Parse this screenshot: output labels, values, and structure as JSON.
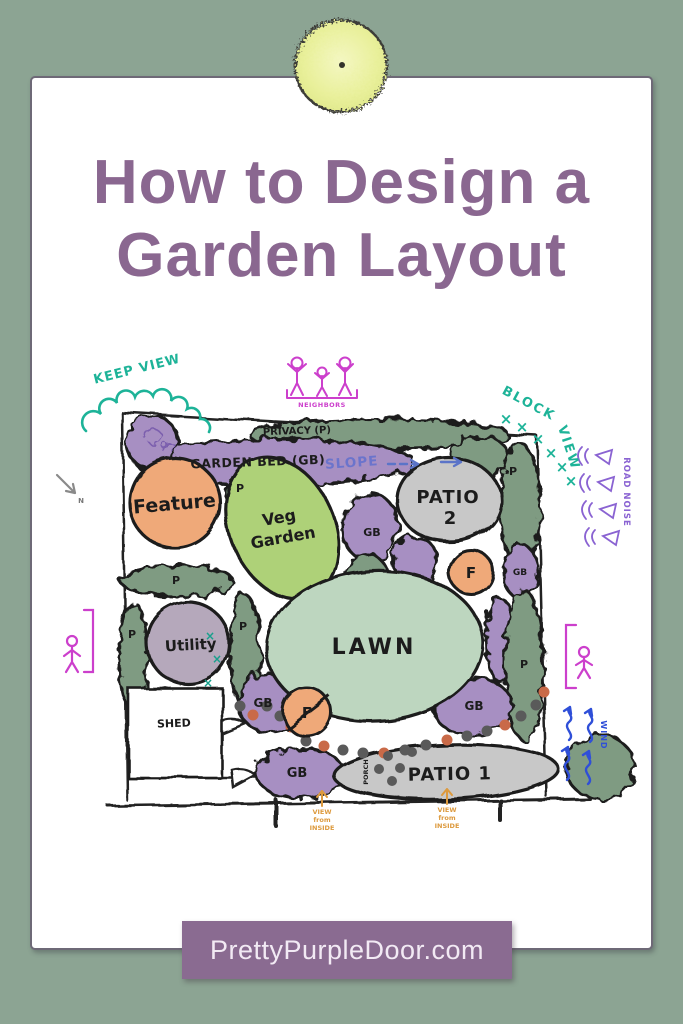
{
  "title": {
    "line1": "How to Design a",
    "line2": "Garden Layout"
  },
  "footer": {
    "website": "PrettyPurpleDoor.com"
  },
  "colors": {
    "background": "#8ca493",
    "title_purple": "#8a6790",
    "banner_purple": "#8a6b91",
    "teal": "#1db398",
    "magenta": "#cc3fcc",
    "road_noise_purple": "#8a63d2",
    "wind_blue": "#2f4fd8",
    "slope_blue": "#6b74cc",
    "view_orange": "#dd9a3e",
    "garden_bed_purple": "#a78fc2",
    "shrub_green": "#7f9b82",
    "veg_green": "#aed178",
    "lawn_green": "#bdd6bf",
    "patio_gray": "#c8c8c8",
    "utility_gray": "#b5a8bb",
    "feature_orange": "#efa979"
  },
  "plan": {
    "annotations": {
      "keep_view": "KEEP VIEW",
      "neighbors": "NEIGHBORS",
      "block_view_l1": "BLOCK",
      "block_view_l2": "VIEW",
      "road_noise": "ROAD NOISE",
      "wind": "WIND",
      "north": "N",
      "slope": "SLOPE",
      "view_inside_l1": "VIEW",
      "view_inside_l2": "from",
      "view_inside_l3": "INSIDE"
    },
    "labels": {
      "privacy": "PRIVACY (P)",
      "garden_bed": "GARDEN BED (GB)",
      "gb": "GB",
      "p": "P",
      "f": "F",
      "x_mark": "×",
      "feature": "Feature",
      "veg_l1": "Veg",
      "veg_l2": "Garden",
      "patio2_l1": "PATIO",
      "patio2_l2": "2",
      "lawn": "LAWN",
      "utility": "Utility",
      "shed": "SHED",
      "patio1": "PATIO 1",
      "porch": "PORCH"
    }
  }
}
